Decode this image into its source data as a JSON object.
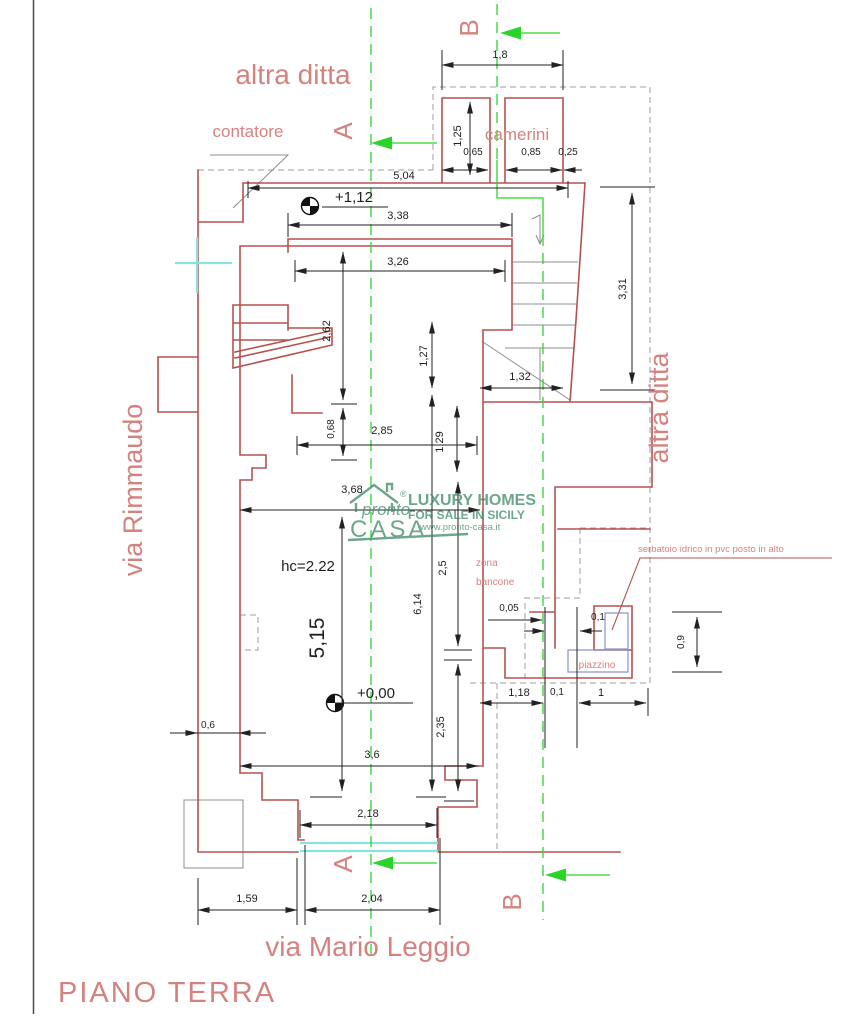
{
  "plan_title": "PIANO TERRA",
  "streets": {
    "left": "via Rimmaudo",
    "bottom": "via Mario Leggio"
  },
  "neighbors": {
    "top": "altra ditta",
    "right": "altra ditta"
  },
  "rooms": {
    "contatore": "contatore",
    "camerini": "camerini",
    "zona_bancone_line1": "zona",
    "zona_bancone_line2": "bancone",
    "piazzino": "piazzino"
  },
  "notes": {
    "serbatoio": "serbatoio idrico in pvc posto in alto",
    "ceiling_height": "hc=2.22"
  },
  "levels": {
    "upper": "+1,12",
    "ground": "+0,00"
  },
  "sections": {
    "a": "A",
    "b": "B"
  },
  "dims": {
    "camerini_total_w": "1,8",
    "camerini_depth": "1,25",
    "camerini_left_w": "0,65",
    "camerini_right_w": "0,85",
    "camerini_wall": "0,25",
    "front_top_w": "5,04",
    "inner_top_w": "3,38",
    "inner_w": "3,26",
    "left_upper_h": "2,62",
    "stair_inner_h": "1,27",
    "stair_total_h": "3,31",
    "stair_w": "1,32",
    "mid_w": "2,85",
    "mid_step_h": "0,68",
    "room_w": "3,68",
    "right_upper_h": "1,29",
    "room_h": "5,15",
    "right_total_h": "6,14",
    "zona_h": "2,5",
    "lower_h": "2,35",
    "left_wall_t": "0,6",
    "lower_w": "3,6",
    "entry_w": "2,18",
    "annex_gap": "0,05",
    "annex_off": "0,1",
    "annex_h": "0,9",
    "annex_w1": "1,18",
    "annex_w2": "0,1",
    "annex_w3": "1",
    "front_left_w": "1,59",
    "front_right_w": "2,04"
  },
  "watermark": {
    "brand_script": "pronto",
    "brand_main": "CASA",
    "registered": "®",
    "tagline1": "LUXURY HOMES",
    "tagline2": "FOR SALE IN SICILY",
    "website": "www.pronto-casa.it"
  },
  "colors": {
    "walls": "#b5524e",
    "labels": "#d5827e",
    "section_lines": "#2bd42b",
    "glazing": "#86e3e3",
    "dimensions": "#1f1f1f",
    "watermark": "#3c8a65",
    "boundary_dashed": "#9c9c9c"
  }
}
